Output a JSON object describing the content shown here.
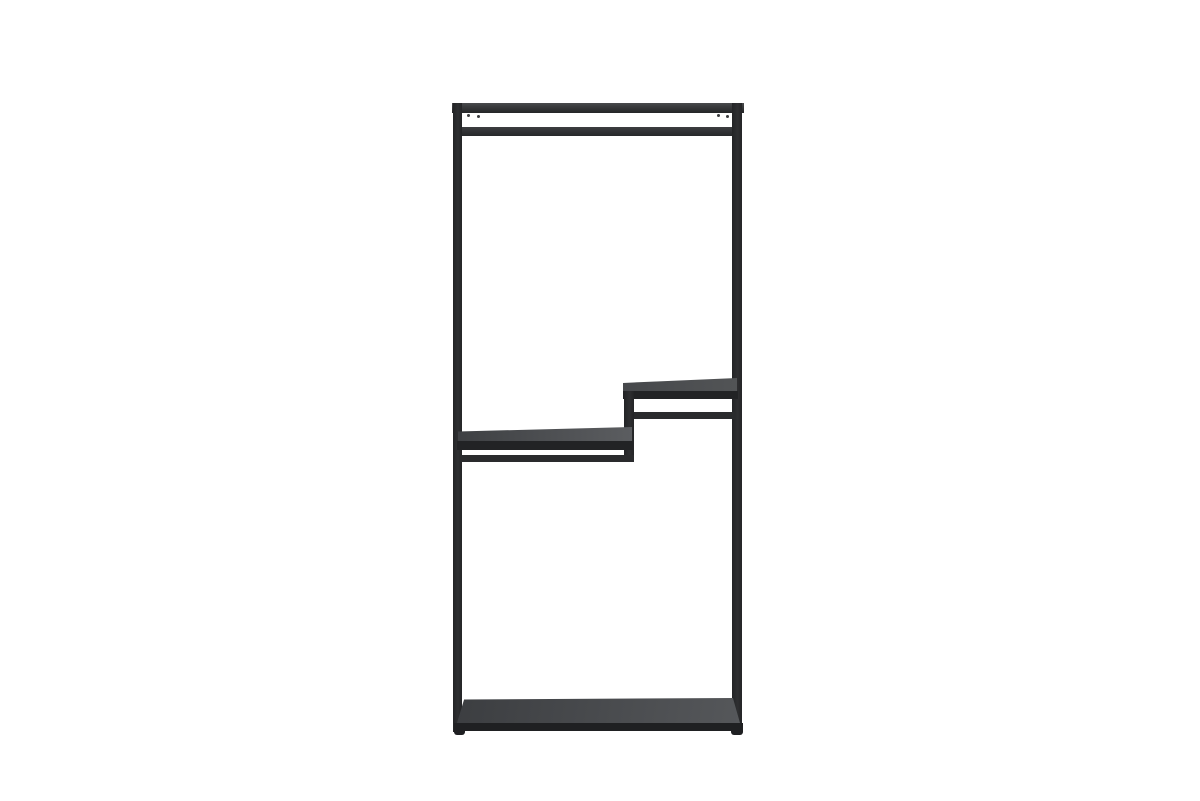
{
  "scene": {
    "type": "product-photo",
    "description": "Minimalist black metal open clothing rack standing on a white studio background. Tall rectangular steel frame with a clothes hanging rail at the top, two staggered mid-height shelves stepping down from right to left, and a full-width bottom shelf with dark grey shelf surfaces.",
    "object": "metal clothing rack / open wardrobe shelving unit",
    "background": "plain white"
  },
  "colors": {
    "background": "#ffffff",
    "frame": "#2a2b2d",
    "frame_dark": "#1f2022",
    "frame_top_light": "#4a4b4e",
    "shelf_edge": "#222325",
    "shelf_left_dark": "#3e4043",
    "shelf_left_light": "#5b5d60",
    "shelf_right_dark": "#46484b",
    "shelf_right_light": "#525456",
    "shelf_bottom_dark": "#3c3e41",
    "shelf_bottom_light": "#55575a",
    "screw": "#3a3b3d"
  },
  "parts": [
    {
      "name": "left-post",
      "label": "left vertical frame post"
    },
    {
      "name": "right-post",
      "label": "right vertical frame post"
    },
    {
      "name": "top-bar",
      "label": "top horizontal frame bar"
    },
    {
      "name": "hanging-rail",
      "label": "clothes hanging rail below top bar"
    },
    {
      "name": "right-shelf",
      "label": "upper staggered shelf on right half"
    },
    {
      "name": "step-post",
      "label": "vertical step connector between mid shelves"
    },
    {
      "name": "left-shelf",
      "label": "lower staggered shelf on left half"
    },
    {
      "name": "bottom-shelf",
      "label": "full-width bottom shelf"
    },
    {
      "name": "feet",
      "label": "small frame feet"
    }
  ]
}
